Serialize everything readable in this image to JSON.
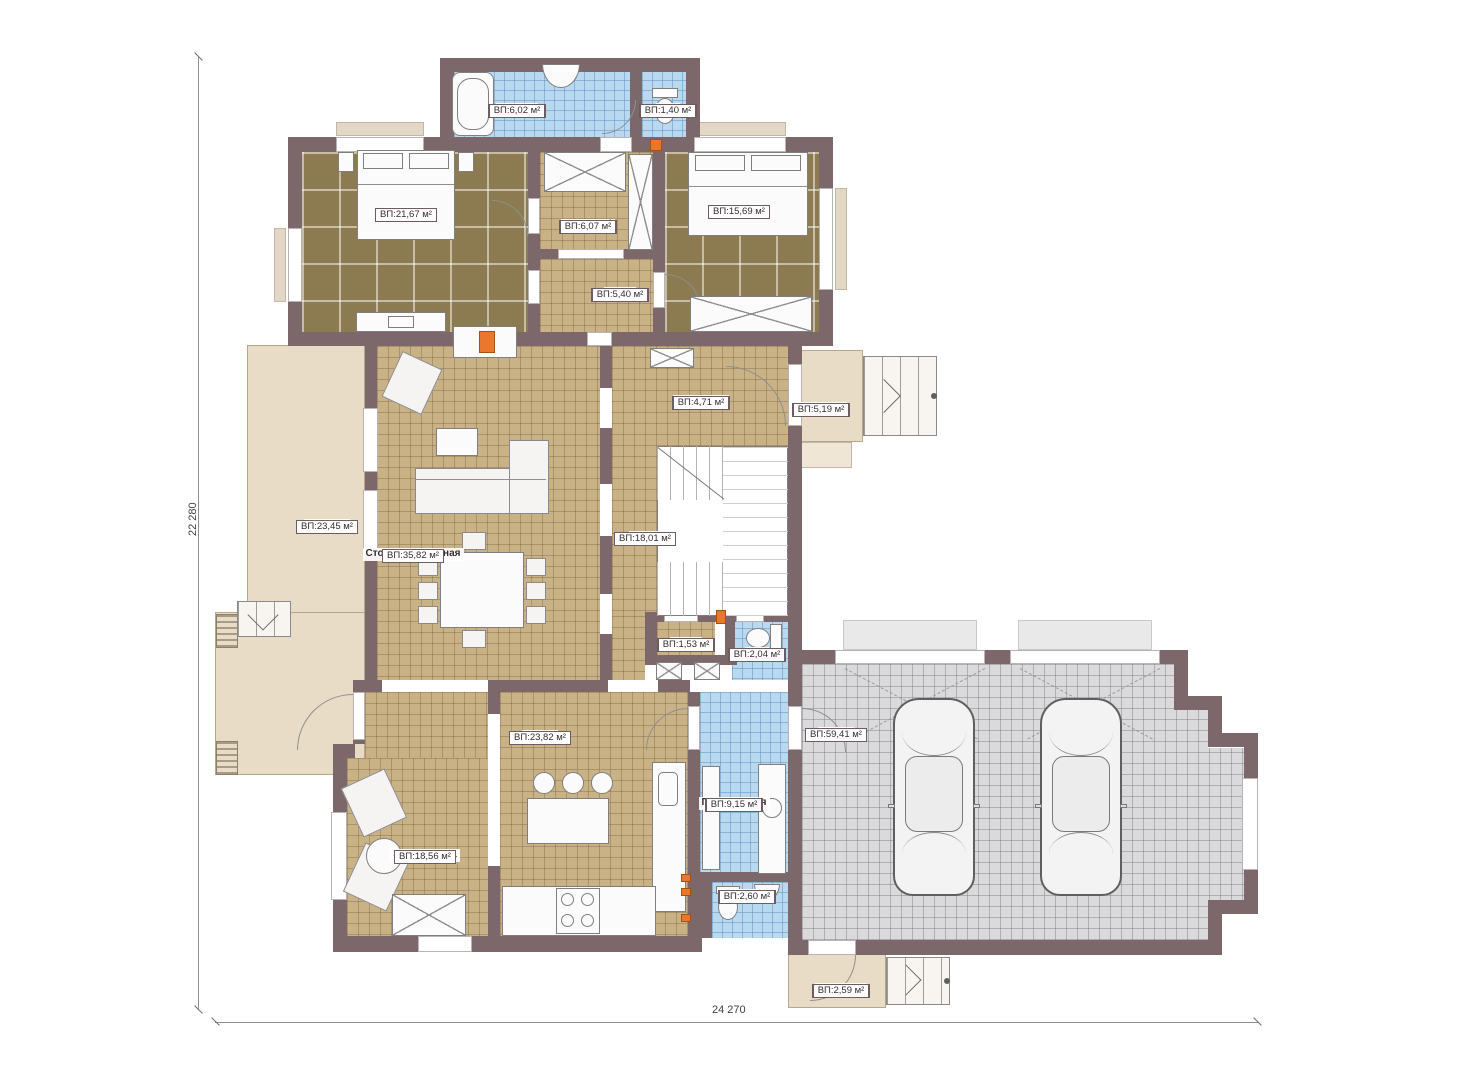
{
  "branding": {
    "watermark": "FixPlans.ru"
  },
  "dimensions": {
    "height_label": "22 280",
    "width_label": "24 270"
  },
  "rooms": [
    {
      "name": "Ванная",
      "area": "ВП:6,02 м²"
    },
    {
      "name": "С.у.",
      "area": "ВП:1,40 м²"
    },
    {
      "name": "Спальня",
      "area": "ВП:21,67 м²"
    },
    {
      "name": "Гардероб",
      "area": "ВП:6,07 м²"
    },
    {
      "name": "Гостевая",
      "area": "ВП:15,69 м²"
    },
    {
      "name": "Холл",
      "area": "ВП:5,40 м²"
    },
    {
      "name": "Прихожая",
      "area": "ВП:4,71 м²"
    },
    {
      "name": "Крыльцо",
      "area": "ВП:5,19 м²"
    },
    {
      "name": "Терраса",
      "area": "ВП:23,45 м²"
    },
    {
      "name": "Столовая-гостиная",
      "area": "ВП:35,82 м²"
    },
    {
      "name": "Холл",
      "area": "ВП:18,01 м²"
    },
    {
      "name": "Холл",
      "area": "ВП:1,53 м²"
    },
    {
      "name": "С.у.",
      "area": "ВП:2,04 м²"
    },
    {
      "name": "Кухня",
      "area": "ВП:23,82 м²"
    },
    {
      "name": "Гараж",
      "area": "ВП:59,41 м²"
    },
    {
      "name": "Постирочная",
      "area": "ВП:9,15 м²"
    },
    {
      "name": "Зона отдыха",
      "area": "ВП:18,56 м²"
    },
    {
      "name": "С.у.",
      "area": "ВП:2,60 м²"
    },
    {
      "name": "Крыльцо",
      "area": "ВП:2,59 м²"
    }
  ],
  "colors": {
    "wall": "#7c676b",
    "floor_wood": "#8c7a50",
    "floor_tile": "#c9b286",
    "floor_wet": "#b9d9f1",
    "floor_garage": "#dadadc",
    "porch": "#e9dcc7",
    "accent_heat": "#e9782e"
  }
}
